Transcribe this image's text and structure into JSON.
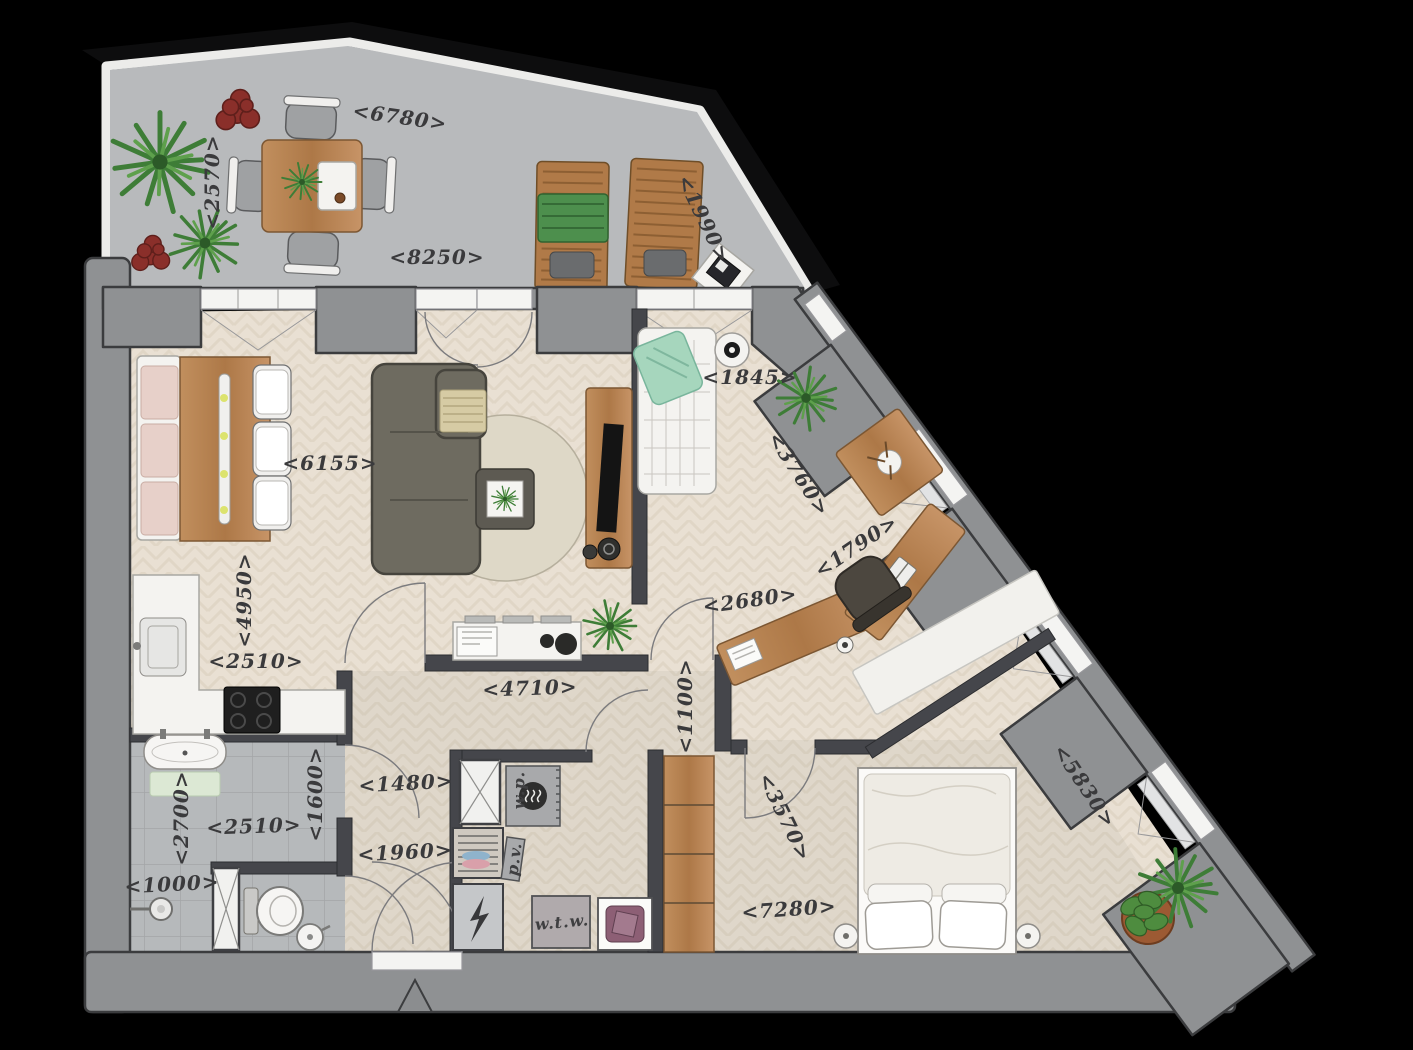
{
  "plan": {
    "type": "apartment-floor-plan",
    "dimensions": [
      {
        "text": "<6780>",
        "x": 400,
        "y": 117,
        "rot": 8
      },
      {
        "text": "<2570>",
        "x": 212,
        "y": 182,
        "rot": -90
      },
      {
        "text": "<8250>",
        "x": 437,
        "y": 257,
        "rot": 0
      },
      {
        "text": "<1990>",
        "x": 704,
        "y": 219,
        "rot": 64
      },
      {
        "text": "<1845>",
        "x": 750,
        "y": 377,
        "rot": 0
      },
      {
        "text": "<6155>",
        "x": 330,
        "y": 463,
        "rot": 0
      },
      {
        "text": "<3760>",
        "x": 799,
        "y": 474,
        "rot": 57
      },
      {
        "text": "<4950>",
        "x": 244,
        "y": 600,
        "rot": -90
      },
      {
        "text": "<1790>",
        "x": 856,
        "y": 546,
        "rot": -34
      },
      {
        "text": "<2680>",
        "x": 750,
        "y": 600,
        "rot": -8
      },
      {
        "text": "<2510>",
        "x": 256,
        "y": 661,
        "rot": 0
      },
      {
        "text": "<4710>",
        "x": 530,
        "y": 688,
        "rot": -2
      },
      {
        "text": "<1100>",
        "x": 685,
        "y": 706,
        "rot": -90
      },
      {
        "text": "<2700>",
        "x": 181,
        "y": 818,
        "rot": -90
      },
      {
        "text": "<1600>",
        "x": 315,
        "y": 794,
        "rot": -90
      },
      {
        "text": "<2510>",
        "x": 254,
        "y": 826,
        "rot": -2
      },
      {
        "text": "<1480>",
        "x": 406,
        "y": 783,
        "rot": -3
      },
      {
        "text": "<1960>",
        "x": 405,
        "y": 852,
        "rot": -3
      },
      {
        "text": "<1000>",
        "x": 172,
        "y": 884,
        "rot": -3
      },
      {
        "text": "<3570>",
        "x": 785,
        "y": 817,
        "rot": 64
      },
      {
        "text": "<7280>",
        "x": 789,
        "y": 909,
        "rot": -4
      },
      {
        "text": "<5830>",
        "x": 1085,
        "y": 786,
        "rot": 56
      }
    ],
    "utility_labels": [
      {
        "text": "w.p.",
        "x": 519,
        "y": 790,
        "rot": -90
      },
      {
        "text": "p.v.",
        "x": 514,
        "y": 859,
        "rot": -83
      },
      {
        "text": "w.t.w.",
        "x": 562,
        "y": 922,
        "rot": -5
      }
    ],
    "colors": {
      "bg": "#000000",
      "wall_fill": "#8f9193",
      "wall_edge": "#3b3c3e",
      "wall_inner": "#45464b",
      "terrace_floor": "#b8babc",
      "floor_wood": "#e9e0d3",
      "floor_wood_line": "#d8cbb9",
      "tile_floor": "#b6b9bb",
      "tile_line": "#a3a6a8",
      "wood_light": "#c79467",
      "wood_dark": "#a87247",
      "sofa_color": "#6e6b60",
      "rug_color": "#ded8c7",
      "mint": "#a6d6bd",
      "pink": "#e7d0c9",
      "red_flower": "#8a2f2a",
      "purple_drum": "#8d5f75",
      "green_dark": "#3e7d37",
      "green_mid": "#5ea04c",
      "label_color": "#3a3a3c"
    }
  }
}
